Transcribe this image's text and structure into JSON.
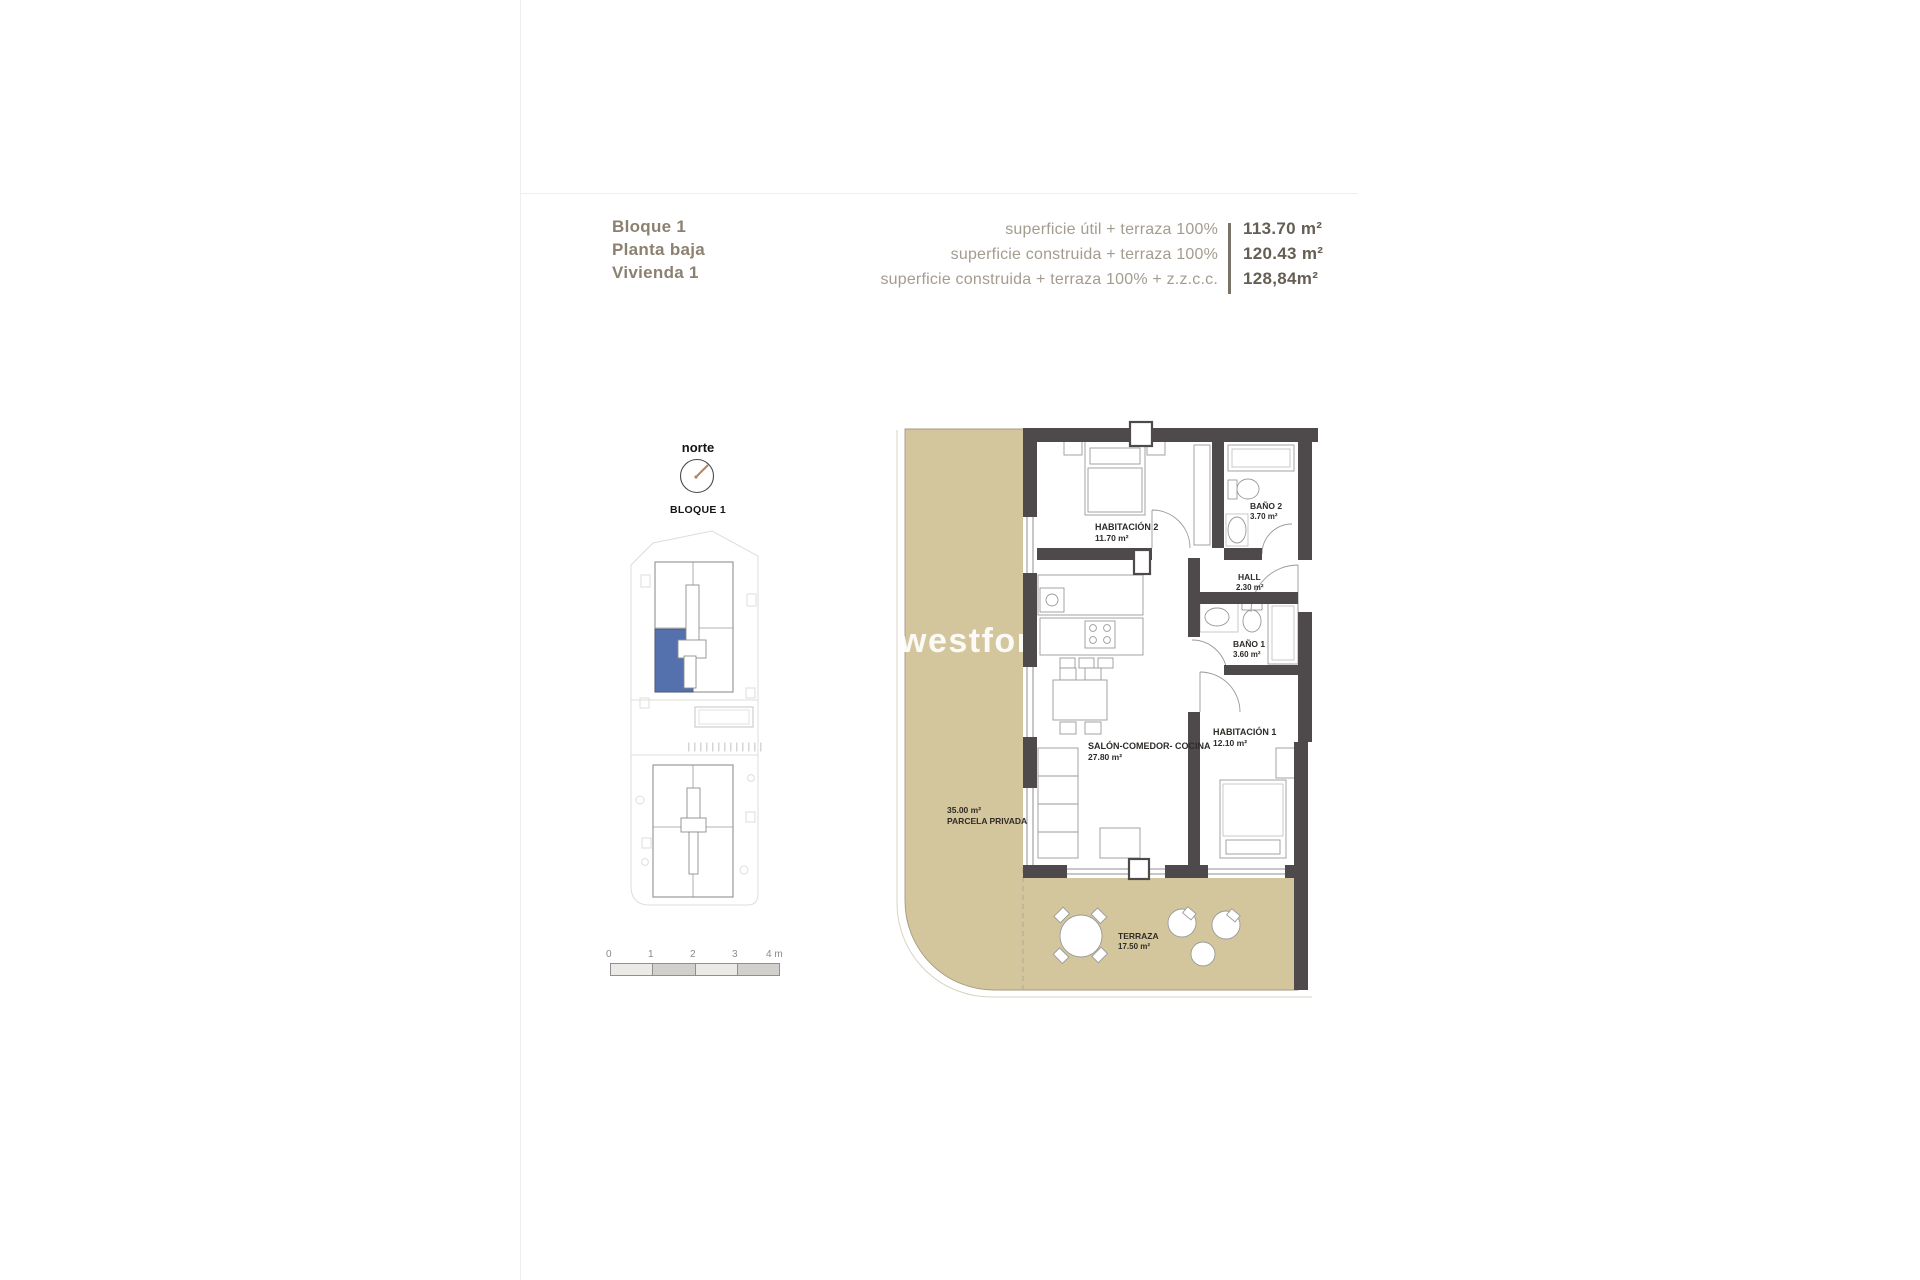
{
  "header": {
    "block": "Bloque 1",
    "floor": "Planta baja",
    "unit": "Vivienda 1",
    "areas": [
      {
        "label": "superficie útil + terraza 100%",
        "value": "113.70 m²"
      },
      {
        "label": "superficie construida + terraza 100%",
        "value": "120.43 m²"
      },
      {
        "label": "superficie construida + terraza 100% + z.z.c.c.",
        "value": "128,84m²"
      }
    ]
  },
  "compass": {
    "label": "norte"
  },
  "siteplan": {
    "title": "BLOQUE 1"
  },
  "scalebar": {
    "labels": [
      "0",
      "1",
      "2",
      "3",
      "4 m"
    ]
  },
  "watermark": "westforhomes",
  "plan": {
    "rooms": {
      "habitacion2": {
        "name": "HABITACIÓN 2",
        "area": "11.70 m²"
      },
      "bano2": {
        "name": "BAÑO 2",
        "area": "3.70 m²"
      },
      "hall": {
        "name": "HALL",
        "area": "2.30 m²"
      },
      "bano1": {
        "name": "BAÑO 1",
        "area": "3.60 m²"
      },
      "salon": {
        "name": "SALÓN-COMEDOR- COCINA",
        "area": "27.80 m²"
      },
      "habitacion1": {
        "name": "HABITACIÓN 1",
        "area": "12.10 m²"
      },
      "terraza": {
        "name": "TERRAZA",
        "area": "17.50 m²"
      },
      "parcela": {
        "area": "35.00 m²",
        "name": "PARCELA PRIVADA"
      }
    }
  },
  "colors": {
    "beige": "#d3c69d",
    "wall": "#4e4a4b",
    "highlight_blue": "#5470ad",
    "header_brown": "#8c8170",
    "header_gray": "#a49c8f",
    "value_dark": "#655e53"
  }
}
